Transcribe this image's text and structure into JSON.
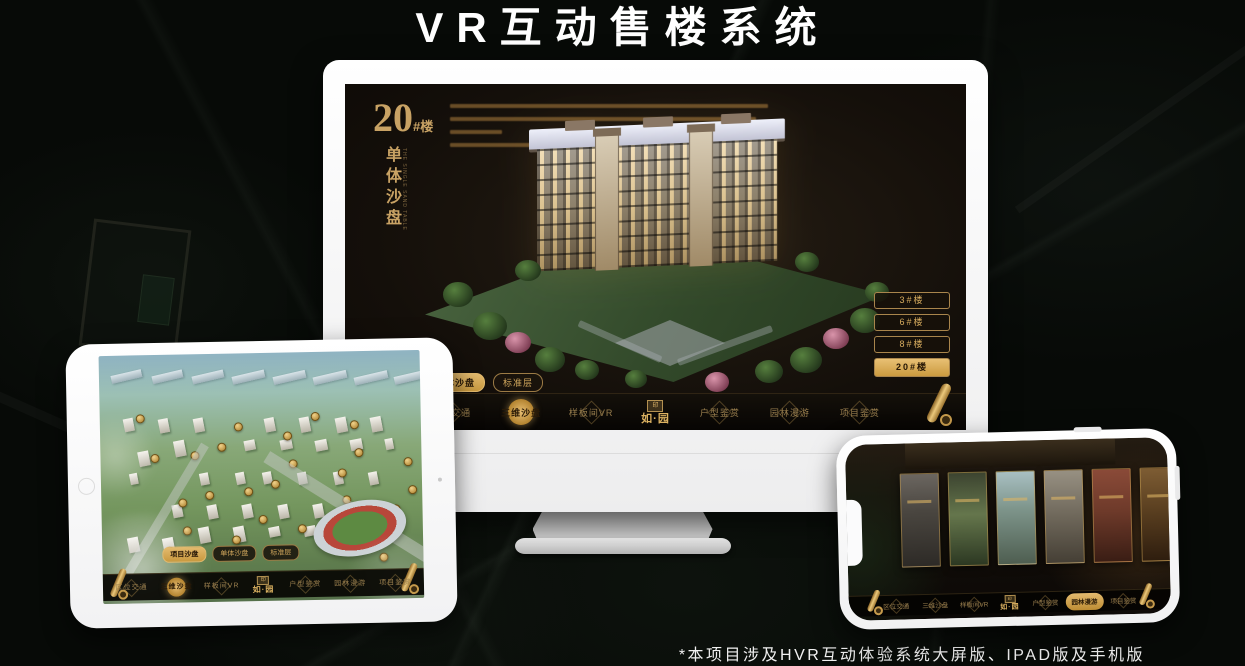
{
  "title": "VR互动售楼系统",
  "footnote": "*本项目涉及HVR互动体验系统大屏版、IPAD版及手机版",
  "brand": {
    "name": "如·园",
    "seal": "印"
  },
  "colors": {
    "gold": "#c99d55",
    "gold_bright": "#e3ba6e",
    "screen_bg": "#16110c",
    "nav_bg": "#0a0805"
  },
  "monitor": {
    "headline_number": "20",
    "headline_suffix": "#楼",
    "headline_vertical": "单体沙盘",
    "headline_vertical_en": "THE SINGLE SAND TABLE",
    "floor_buttons": [
      {
        "label": "3#楼",
        "active": false
      },
      {
        "label": "6#楼",
        "active": false
      },
      {
        "label": "8#楼",
        "active": false
      },
      {
        "label": "20#楼",
        "active": true
      }
    ],
    "view_tabs": [
      {
        "label": "项目沙盘",
        "active": false
      },
      {
        "label": "单体沙盘",
        "active": true
      },
      {
        "label": "标准层",
        "active": false
      }
    ],
    "nav_left": [
      {
        "label": "区位交通",
        "active": false
      },
      {
        "label": "三维沙盘",
        "active": true
      },
      {
        "label": "样板间VR",
        "active": false
      }
    ],
    "nav_right": [
      {
        "label": "户型鉴赏",
        "active": false
      },
      {
        "label": "园林漫游",
        "active": false
      },
      {
        "label": "项目鉴赏",
        "active": false
      }
    ]
  },
  "tablet": {
    "view_tabs": [
      {
        "label": "项目沙盘",
        "active": true
      },
      {
        "label": "单体沙盘",
        "active": false
      },
      {
        "label": "标准层",
        "active": false
      }
    ],
    "nav_left": [
      {
        "label": "区位交通",
        "active": false
      },
      {
        "label": "三维沙盘",
        "active": true
      },
      {
        "label": "样板间VR",
        "active": false
      }
    ],
    "nav_right": [
      {
        "label": "户型鉴赏",
        "active": false
      },
      {
        "label": "园林漫游",
        "active": false
      },
      {
        "label": "项目鉴赏",
        "active": false
      }
    ],
    "badge_count": 26
  },
  "phone": {
    "nav_left": [
      {
        "label": "区位交通",
        "active": false
      },
      {
        "label": "三维沙盘",
        "active": false
      },
      {
        "label": "样板间VR",
        "active": false
      }
    ],
    "nav_right": [
      {
        "label": "户型鉴赏",
        "active": false
      },
      {
        "label": "园林漫游",
        "active": true
      },
      {
        "label": "项目鉴赏",
        "active": false
      }
    ],
    "cards": [
      {
        "name": "arch-gray"
      },
      {
        "name": "garden-green"
      },
      {
        "name": "sky-building"
      },
      {
        "name": "facade"
      },
      {
        "name": "autumn"
      },
      {
        "name": "interior-warm"
      }
    ]
  }
}
